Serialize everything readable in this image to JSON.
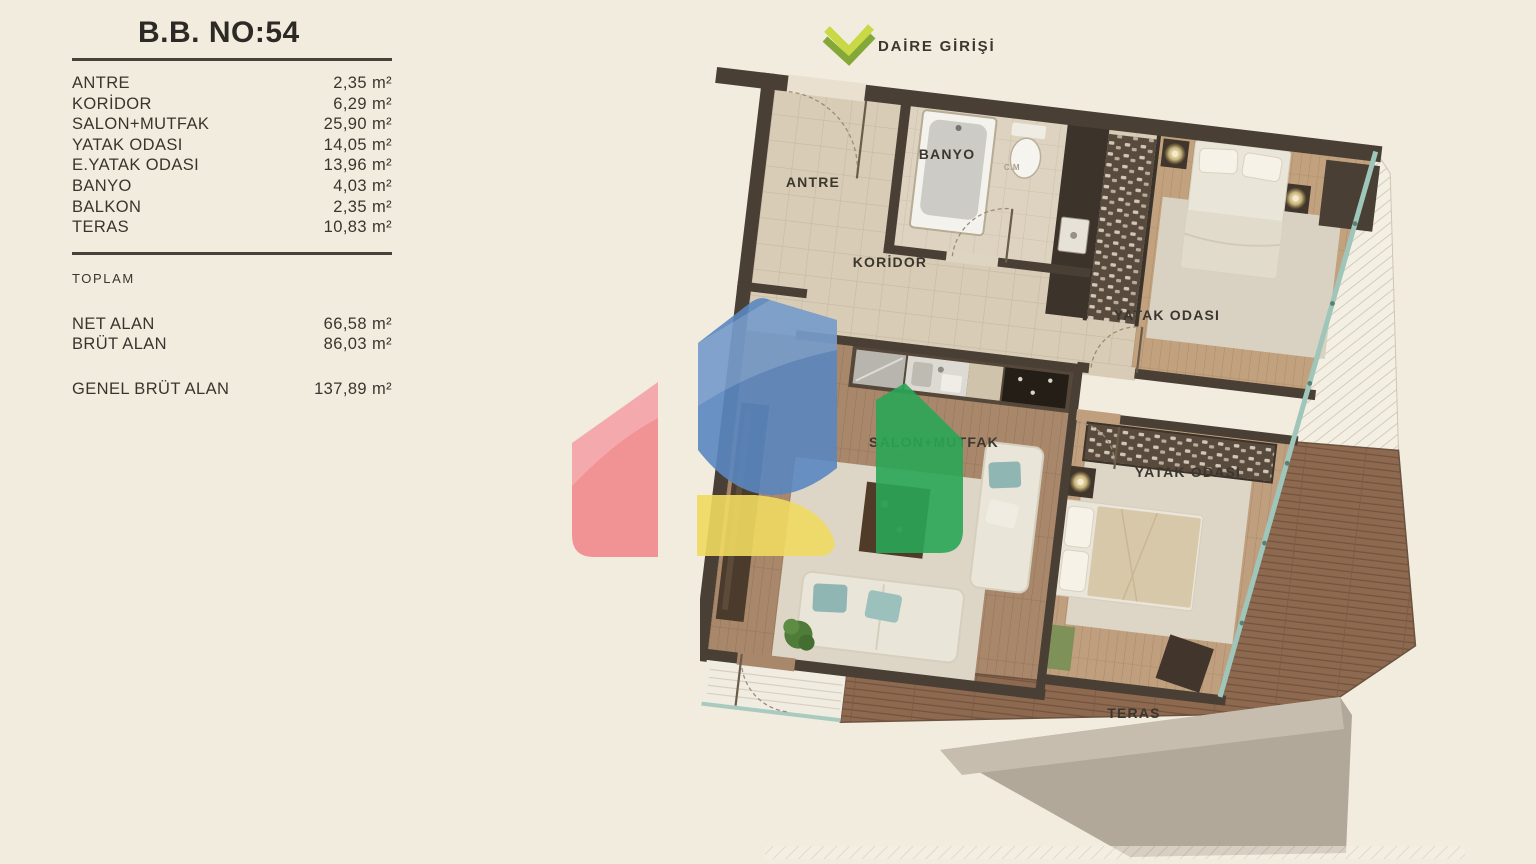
{
  "unit": {
    "title": "B.B. NO:54",
    "rooms": [
      {
        "label": "ANTRE",
        "area": "2,35 m²"
      },
      {
        "label": "KORİDOR",
        "area": "6,29 m²"
      },
      {
        "label": "SALON+MUTFAK",
        "area": "25,90 m²"
      },
      {
        "label": "YATAK ODASI",
        "area": "14,05 m²"
      },
      {
        "label": "E.YATAK ODASI",
        "area": "13,96 m²"
      },
      {
        "label": "BANYO",
        "area": "4,03 m²"
      },
      {
        "label": "BALKON",
        "area": "2,35 m²"
      },
      {
        "label": "TERAS",
        "area": "10,83 m²"
      }
    ],
    "totals_header": "TOPLAM",
    "totals": [
      {
        "label": "NET ALAN",
        "area": "66,58 m²"
      },
      {
        "label": "BRÜT ALAN",
        "area": "86,03 m²"
      }
    ],
    "grand_total": {
      "label": "GENEL BRÜT ALAN",
      "area": "137,89 m²"
    }
  },
  "plan": {
    "entrance_label": "DAİRE GİRİŞİ",
    "labels": {
      "antre": "ANTRE",
      "banyo": "BANYO",
      "cm": "C.M",
      "koridor": "KORİDOR",
      "bedroom1": "YATAK ODASI",
      "salon": "SALON+MUTFAK",
      "bedroom2": "YATAK ODASI",
      "teras": "TERAS"
    },
    "icons": {
      "entrance_arrow": "double-chevron-down-left"
    }
  },
  "watermark": {
    "colors": {
      "red": "#f18a8d",
      "blue": "#5a87c0",
      "yellow": "#f0da60",
      "green": "#2aa657"
    }
  }
}
